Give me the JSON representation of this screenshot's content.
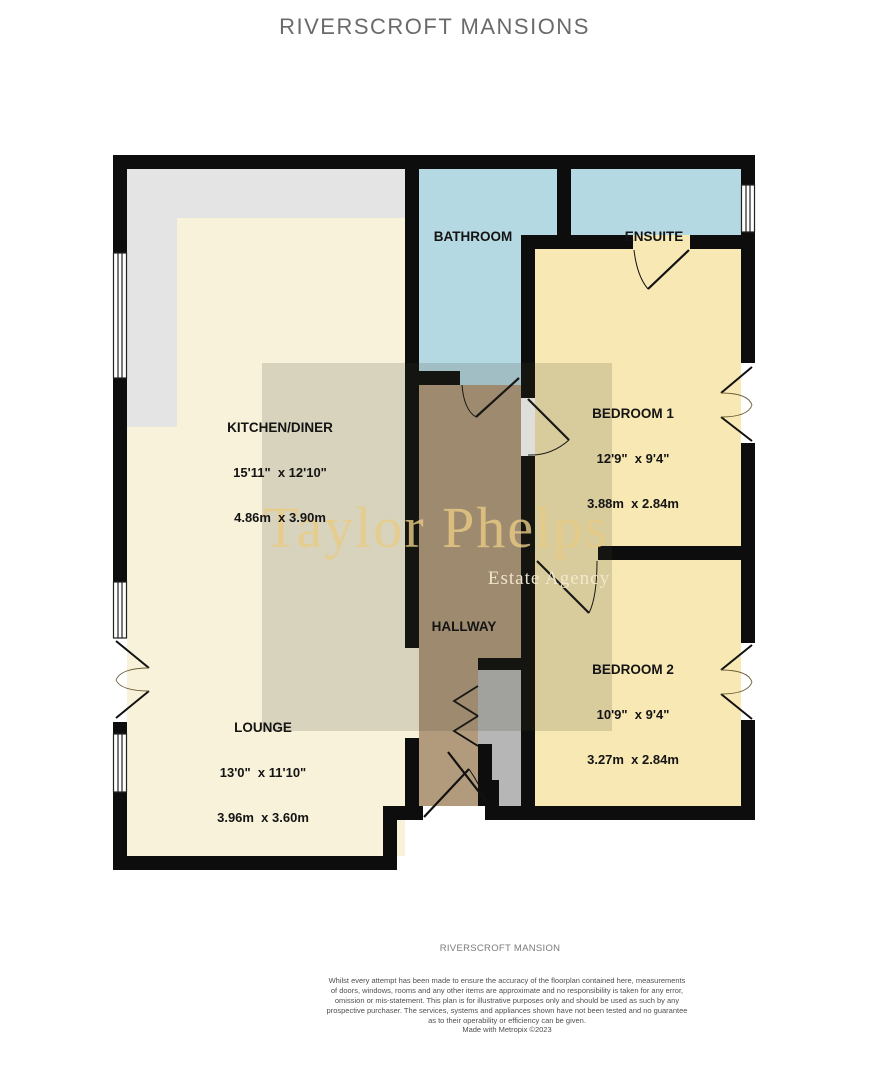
{
  "title": "RIVERSCROFT MANSIONS",
  "watermark": {
    "name": "Taylor Phelps",
    "subtitle": "Estate Agency"
  },
  "rooms": {
    "bathroom": {
      "name": "BATHROOM"
    },
    "ensuite": {
      "name": "ENSUITE"
    },
    "kitchen_diner": {
      "name": "KITCHEN/DINER",
      "size_imperial": "15'11\"  x 12'10\"",
      "size_metric": "4.86m  x 3.90m"
    },
    "bedroom1": {
      "name": "BEDROOM 1",
      "size_imperial": "12'9\"  x 9'4\"",
      "size_metric": "3.88m  x 2.84m"
    },
    "hallway": {
      "name": "HALLWAY"
    },
    "bedroom2": {
      "name": "BEDROOM 2",
      "size_imperial": "10'9\"  x 9'4\"",
      "size_metric": "3.27m  x 2.84m"
    },
    "lounge": {
      "name": "LOUNGE",
      "size_imperial": "13'0\"  x 11'10\"",
      "size_metric": "3.96m  x 3.60m"
    },
    "storage": {
      "name": "STORAGE"
    }
  },
  "footer": {
    "property_name": "RIVERSCROFT MANSION",
    "disclaimer": "Whilst every attempt has been made to ensure the accuracy of the floorplan contained here, measurements\nof doors, windows, rooms and any other items are approximate and no responsibility is taken for any error,\nomission or mis-statement. This plan is for illustrative purposes only and should be used as such by any\nprospective purchaser. The services, systems and appliances shown have not been tested and no guarantee\nas to their operability or efficiency can be given.\nMade with Metropix ©2023"
  },
  "colors": {
    "wall": "#0d0d0d",
    "room-cream": "#f8f2da",
    "room-blue": "#b5d9e2",
    "room-yellow": "#f8e8b4",
    "room-brown": "#b29b7c",
    "counter-gray": "#e4e4e4",
    "storage-gray": "#b6b6b6",
    "watermark-gold": "#e8cc85",
    "title-gray": "#6a6a6a"
  }
}
